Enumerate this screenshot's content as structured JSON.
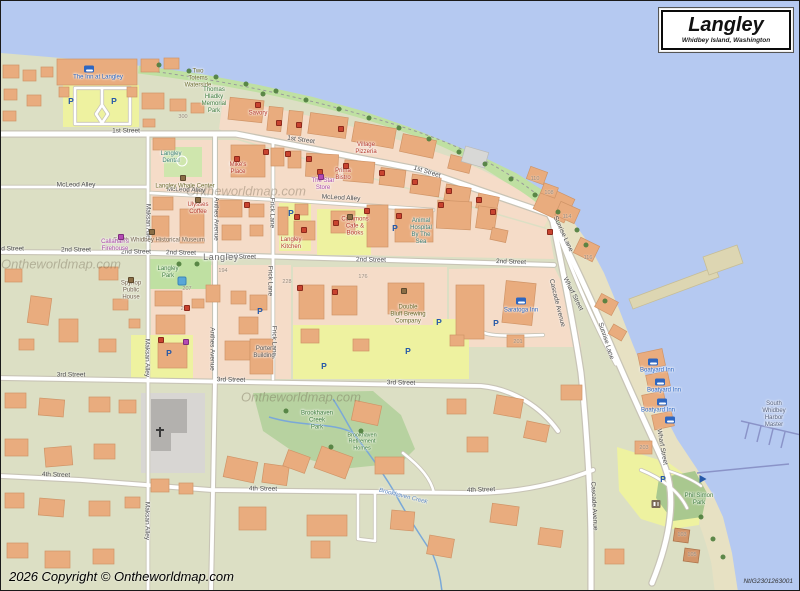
{
  "title_box": {
    "title": "Langley",
    "subtitle": "Whidbey Island, Washington"
  },
  "copyright": "2026 Copyright © Ontheworldmap.com",
  "map_code": "NtIG2301263001",
  "watermark": "Ontheworldmap.com",
  "colors": {
    "land": "#dcdfc4",
    "water": "#b5c9f1",
    "sand": "#e7e1c3",
    "shore-green": "#bfe0a2",
    "park": "#b7d2a0",
    "pink": "#f5dcc8",
    "lot-yellow": "#eef2a0",
    "building": "#e9ac7e",
    "road": "#ffffff"
  },
  "streets": [
    {
      "t": "1st Street",
      "x": 125,
      "y": 130,
      "r": 0
    },
    {
      "t": "1st Street",
      "x": 300,
      "y": 139,
      "r": 8
    },
    {
      "t": "1st Street",
      "x": 426,
      "y": 171,
      "r": 17
    },
    {
      "t": "McLeod Alley",
      "x": 75,
      "y": 184,
      "r": 0
    },
    {
      "t": "McLeod Alley",
      "x": 185,
      "y": 189,
      "r": 2
    },
    {
      "t": "McLeod Alley",
      "x": 340,
      "y": 197,
      "r": 3
    },
    {
      "t": "2nd Street",
      "x": 8,
      "y": 248,
      "r": 0
    },
    {
      "t": "2nd Street",
      "x": 75,
      "y": 249,
      "r": 0
    },
    {
      "t": "2nd Street",
      "x": 135,
      "y": 251,
      "r": 0
    },
    {
      "t": "2nd Street",
      "x": 180,
      "y": 252,
      "r": 1
    },
    {
      "t": "2nd Street",
      "x": 240,
      "y": 256,
      "r": 1
    },
    {
      "t": "2nd Street",
      "x": 370,
      "y": 259,
      "r": 1
    },
    {
      "t": "2nd Street",
      "x": 510,
      "y": 261,
      "r": 2
    },
    {
      "t": "3rd Street",
      "x": 70,
      "y": 374,
      "r": 0
    },
    {
      "t": "3rd Street",
      "x": 230,
      "y": 379,
      "r": 1
    },
    {
      "t": "3rd Street",
      "x": 400,
      "y": 382,
      "r": 1
    },
    {
      "t": "4th Street",
      "x": 55,
      "y": 474,
      "r": 2
    },
    {
      "t": "4th Street",
      "x": 262,
      "y": 488,
      "r": 1
    },
    {
      "t": "4th Street",
      "x": 480,
      "y": 489,
      "r": -2
    },
    {
      "t": "Maksan Alley",
      "x": 147,
      "y": 222,
      "r": 90
    },
    {
      "t": "Maksan Alley",
      "x": 146,
      "y": 357,
      "r": 90
    },
    {
      "t": "Maksan Alley",
      "x": 146,
      "y": 520,
      "r": 90
    },
    {
      "t": "Anthes Avenue",
      "x": 215,
      "y": 218,
      "r": 90
    },
    {
      "t": "Anthes Avenue",
      "x": 211,
      "y": 348,
      "r": 90
    },
    {
      "t": "Frick Lane",
      "x": 271,
      "y": 212,
      "r": 90
    },
    {
      "t": "Frick Lane",
      "x": 269,
      "y": 280,
      "r": 90
    },
    {
      "t": "Frick Lane",
      "x": 273,
      "y": 340,
      "r": 90
    },
    {
      "t": "Sunrise Lane",
      "x": 562,
      "y": 233,
      "r": 65
    },
    {
      "t": "Sunrise Lane",
      "x": 605,
      "y": 340,
      "r": 72
    },
    {
      "t": "Wharf Street",
      "x": 572,
      "y": 293,
      "r": 63
    },
    {
      "t": "Wharf Street",
      "x": 661,
      "y": 446,
      "r": 80
    },
    {
      "t": "Cascade Avenue",
      "x": 556,
      "y": 302,
      "r": 76
    },
    {
      "t": "Cascade Avenue",
      "x": 593,
      "y": 505,
      "r": 87
    }
  ],
  "pois": [
    {
      "t": "The Inn at Langley",
      "x": 97,
      "y": 77,
      "c": "blue"
    },
    {
      "t": "Two\nTotems\nWaterside",
      "x": 197,
      "y": 78,
      "c": "olive"
    },
    {
      "t": "Thomas\nHladky\nMemorial\nPark",
      "x": 213,
      "y": 100,
      "c": "green"
    },
    {
      "t": "Savory",
      "x": 257,
      "y": 113,
      "c": "red"
    },
    {
      "t": "Village\nPizzeria",
      "x": 365,
      "y": 148,
      "c": "red"
    },
    {
      "t": "Mike's\nPlace",
      "x": 237,
      "y": 168,
      "c": "red"
    },
    {
      "t": "Langley\nDental",
      "x": 170,
      "y": 157,
      "c": "teal"
    },
    {
      "t": "Langley Whale Center",
      "x": 184,
      "y": 186,
      "c": "olive"
    },
    {
      "t": "The Star\nStore",
      "x": 322,
      "y": 184,
      "c": "magenta"
    },
    {
      "t": "Prima\nBistro",
      "x": 342,
      "y": 174,
      "c": "red"
    },
    {
      "t": "Ulysses\nCoffee",
      "x": 197,
      "y": 208,
      "c": "red"
    },
    {
      "t": "South Whidbey Historical Museum",
      "x": 158,
      "y": 240,
      "c": "brown"
    },
    {
      "t": "Callahan's\nFirehouse",
      "x": 114,
      "y": 245,
      "c": "magenta"
    },
    {
      "t": "Commons\nCafe &\nBooks",
      "x": 354,
      "y": 226,
      "c": "red"
    },
    {
      "t": "Langley\nKitchen",
      "x": 290,
      "y": 243,
      "c": "red"
    },
    {
      "t": "Animal\nHospital\nBy The\nSea",
      "x": 420,
      "y": 231,
      "c": "teal"
    },
    {
      "t": "Spyhop\nPublic\nHouse",
      "x": 130,
      "y": 290,
      "c": "brown"
    },
    {
      "t": "Double\nBluff Brewing\nCompany",
      "x": 407,
      "y": 314,
      "c": "olive"
    },
    {
      "t": "Porter\nBuilding",
      "x": 263,
      "y": 352,
      "c": "dark"
    },
    {
      "t": "Langley\nPark",
      "x": 167,
      "y": 272,
      "c": "green"
    },
    {
      "t": "Brookhaven\nCreek\nPark",
      "x": 316,
      "y": 420,
      "c": "green"
    },
    {
      "t": "Brookhaven\nRetirement\nHomes",
      "x": 361,
      "y": 441,
      "c": "green",
      "s": 5.5
    },
    {
      "t": "Phil Simon\nPark",
      "x": 698,
      "y": 499,
      "c": "green"
    },
    {
      "t": "Saratoga Inn",
      "x": 520,
      "y": 310,
      "c": "blue"
    },
    {
      "t": "Boatyard Inn",
      "x": 656,
      "y": 370,
      "c": "blue"
    },
    {
      "t": "Boatyard Inn",
      "x": 663,
      "y": 390,
      "c": "blue"
    },
    {
      "t": "Boatyard Inn",
      "x": 657,
      "y": 410,
      "c": "blue"
    },
    {
      "t": "South\nWhidbey\nHarbor\nMaster",
      "x": 773,
      "y": 414,
      "c": "slate"
    },
    {
      "t": "Langley",
      "x": 220,
      "y": 256,
      "c": "town"
    },
    {
      "t": "Brookhaven Creek",
      "x": 402,
      "y": 496,
      "c": "water",
      "r": 14
    }
  ],
  "house_numbers": [
    {
      "t": "300",
      "x": 182,
      "y": 116
    },
    {
      "t": "176",
      "x": 362,
      "y": 276
    },
    {
      "t": "228",
      "x": 286,
      "y": 281
    },
    {
      "t": "194",
      "x": 222,
      "y": 270
    },
    {
      "t": "207",
      "x": 186,
      "y": 288
    },
    {
      "t": "211",
      "x": 184,
      "y": 308
    },
    {
      "t": "201",
      "x": 517,
      "y": 341
    },
    {
      "t": "203",
      "x": 643,
      "y": 447
    },
    {
      "t": "110",
      "x": 534,
      "y": 178
    },
    {
      "t": "108",
      "x": 548,
      "y": 192
    },
    {
      "t": "114",
      "x": 566,
      "y": 216
    },
    {
      "t": "116",
      "x": 587,
      "y": 257
    },
    {
      "t": "103",
      "x": 681,
      "y": 534
    },
    {
      "t": "105",
      "x": 691,
      "y": 554
    }
  ],
  "icons": {
    "bed": [
      [
        88,
        68
      ],
      [
        520,
        300
      ],
      [
        652,
        361
      ],
      [
        659,
        381
      ],
      [
        661,
        401
      ],
      [
        669,
        419
      ]
    ],
    "parking": [
      [
        70,
        100
      ],
      [
        113,
        100
      ],
      [
        290,
        212
      ],
      [
        394,
        227
      ],
      [
        438,
        321
      ],
      [
        407,
        350
      ],
      [
        323,
        365
      ],
      [
        168,
        352
      ],
      [
        259,
        310
      ],
      [
        662,
        478
      ],
      [
        495,
        322
      ]
    ],
    "dot-red": [
      [
        278,
        122
      ],
      [
        298,
        124
      ],
      [
        340,
        128
      ],
      [
        257,
        104
      ],
      [
        236,
        158
      ],
      [
        265,
        151
      ],
      [
        287,
        153
      ],
      [
        308,
        158
      ],
      [
        345,
        165
      ],
      [
        381,
        172
      ],
      [
        414,
        181
      ],
      [
        448,
        190
      ],
      [
        478,
        199
      ],
      [
        492,
        211
      ],
      [
        246,
        204
      ],
      [
        296,
        216
      ],
      [
        303,
        229
      ],
      [
        335,
        222
      ],
      [
        366,
        210
      ],
      [
        398,
        215
      ],
      [
        440,
        204
      ],
      [
        549,
        231
      ],
      [
        299,
        287
      ],
      [
        334,
        291
      ],
      [
        160,
        339
      ],
      [
        186,
        307
      ],
      [
        319,
        171
      ]
    ],
    "dot-magenta": [
      [
        120,
        236
      ],
      [
        320,
        176
      ],
      [
        185,
        341
      ]
    ],
    "dot-brown": [
      [
        151,
        231
      ],
      [
        403,
        290
      ],
      [
        130,
        279
      ],
      [
        349,
        216
      ],
      [
        197,
        199
      ],
      [
        182,
        177
      ]
    ],
    "playground": [
      [
        181,
        280
      ]
    ],
    "restroom": [
      [
        655,
        503
      ]
    ],
    "boat-launch": [
      [
        702,
        478
      ]
    ],
    "church-cross": [
      [
        159,
        431
      ]
    ],
    "fountain": [
      [
        181,
        160
      ]
    ],
    "tree": [
      [
        158,
        64
      ],
      [
        188,
        70
      ],
      [
        215,
        76
      ],
      [
        245,
        83
      ],
      [
        275,
        90
      ],
      [
        305,
        99
      ],
      [
        338,
        108
      ],
      [
        368,
        117
      ],
      [
        398,
        127
      ],
      [
        428,
        138
      ],
      [
        458,
        151
      ],
      [
        484,
        163
      ],
      [
        510,
        178
      ],
      [
        534,
        194
      ],
      [
        557,
        211
      ],
      [
        576,
        229
      ],
      [
        262,
        93
      ],
      [
        178,
        263
      ],
      [
        196,
        263
      ],
      [
        285,
        410
      ],
      [
        330,
        446
      ],
      [
        360,
        430
      ],
      [
        700,
        516
      ],
      [
        712,
        538
      ],
      [
        722,
        556
      ],
      [
        585,
        244
      ],
      [
        604,
        300
      ]
    ]
  },
  "watermarks": [
    {
      "x": 60,
      "y": 263
    },
    {
      "x": 300,
      "y": 396
    },
    {
      "x": 245,
      "y": 190
    }
  ]
}
